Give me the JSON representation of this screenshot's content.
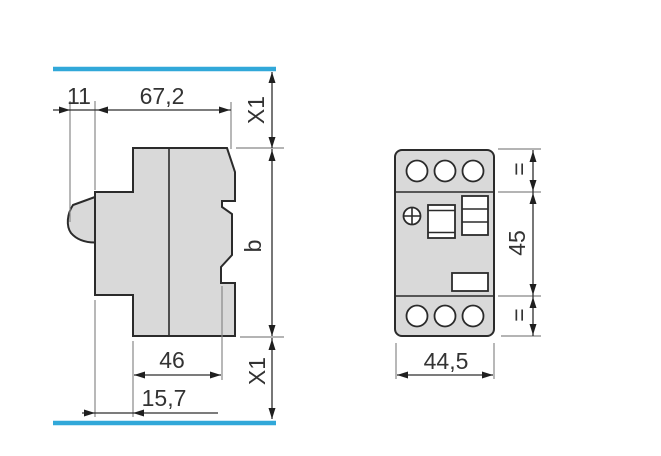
{
  "colors": {
    "accent": "#31a8d9",
    "body_fill": "#d9d9d9",
    "outline": "#2b2b2b",
    "dimension_line": "#2e2e2e",
    "extension_line": "#888888",
    "text": "#333333"
  },
  "side_view": {
    "dim_front_protrusion": "11",
    "dim_depth": "67,2",
    "dim_clearance_top": "X1",
    "dim_height": "b",
    "dim_body_width": "46",
    "dim_rear_offset": "15,7",
    "dim_clearance_bottom": "X1"
  },
  "front_view": {
    "dim_equal_top": "=",
    "dim_mounting_height": "45",
    "dim_equal_bottom": "=",
    "dim_width": "44,5"
  }
}
